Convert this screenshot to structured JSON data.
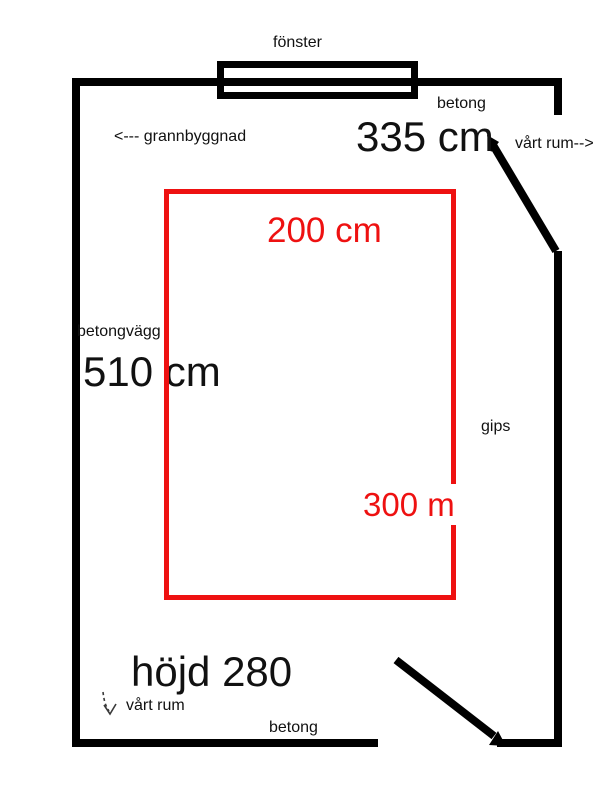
{
  "colors": {
    "wall": "#000000",
    "annotation_red": "#ee1111",
    "background": "#ffffff"
  },
  "plan": {
    "window_label": "fönster",
    "top_material_label": "betong",
    "top_length_label": "335 cm",
    "our_room_top_label": "vårt rum-->",
    "neighbor_label": "<--- grannbyggnad",
    "red_width_label": "200 cm",
    "left_material_label": "betongvägg",
    "left_length_label": "510 cm",
    "right_material_label": "gips",
    "red_height_label": "300 m",
    "height_label": "höjd 280",
    "our_room_bottom_label": "vårt rum",
    "bottom_material_label": "betong"
  }
}
